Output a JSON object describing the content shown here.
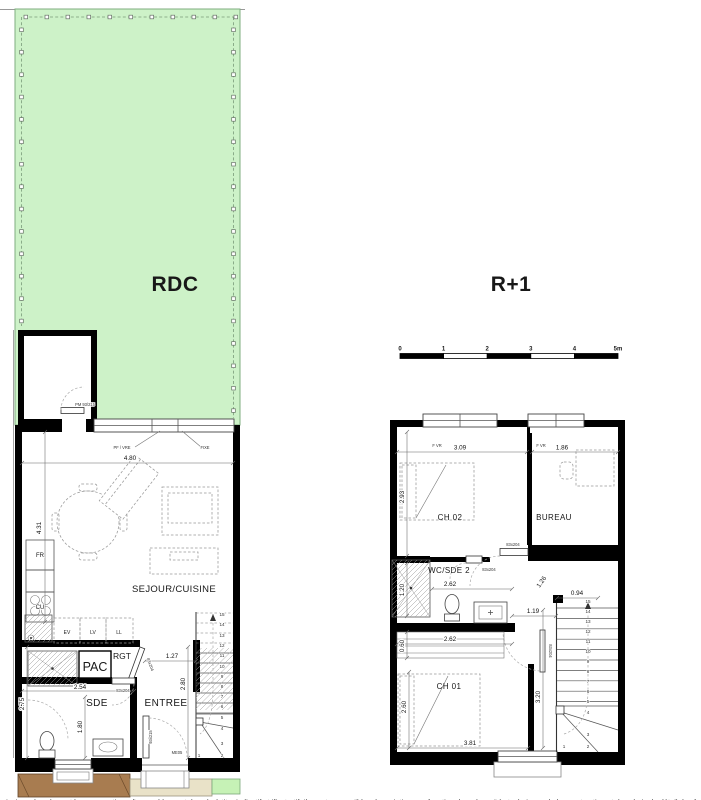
{
  "titles": {
    "rdc": "RDC",
    "r1": "R+1"
  },
  "scalebar": {
    "ticks": [
      "0",
      "1",
      "2",
      "3",
      "4",
      "5m"
    ]
  },
  "colors": {
    "garden": "#cdf2c8",
    "terrace": "#a87c50",
    "paving": "#e9e2c8",
    "grass": "#c6f2b6"
  },
  "rdc": {
    "annex_door_label": "PM 93/215",
    "window_left": "PF / VRE",
    "window_right": "FIXE",
    "dim_width": "4.80",
    "dim_height": "4.31",
    "appliance_fr": "FR",
    "appliance_cu": "CU",
    "appliance_ev": "EV",
    "appliance_lv": "LV",
    "appliance_ll": "LL",
    "room_main": "SEJOUR/CUISINE",
    "room_pac": "PAC",
    "room_rgt": "RGT",
    "room_sde": "SDE",
    "room_entree": "ENTREE",
    "dim_rgt": "1.27",
    "door_rgt": "83x204",
    "dim_sde_w": "2.54",
    "door_sde": "83x204",
    "dim_sde_h": "2.75",
    "dim_sde_inner": "1.80",
    "dim_entree_h": "2.80",
    "entry_door_size": "93x215",
    "entry_door_code": "ME05",
    "stair_numbers": [
      "15",
      "14",
      "13",
      "12",
      "11",
      "10",
      "9",
      "8",
      "7",
      "6",
      "5",
      "4",
      "3",
      "2",
      "1"
    ]
  },
  "r1": {
    "window_left_label": "F VR",
    "window_left_dim": "3.09",
    "window_right_label": "F VR",
    "window_right_dim": "1.86",
    "room_ch02": "CH 02",
    "room_bureau": "BUREAU",
    "room_wc": "WC/SDE 2",
    "room_ch01": "CH 01",
    "dim_ch02_h": "2.93",
    "dim_wc_h": "1.20",
    "dim_wc_w": "2.62",
    "dim_closet_w": "2.62",
    "dim_closet_h": "0.60",
    "dim_landing": "1.19",
    "dim_stair_top": "0.94",
    "dim_door_diag": "1.26",
    "door_landing": "83x204",
    "door_wc": "83x204",
    "door_ch01": "83x204",
    "dim_ch01_h": "2.60",
    "dim_ch01_w": "3.81",
    "dim_hall_h": "3.20",
    "stair_numbers": [
      "15",
      "14",
      "13",
      "12",
      "11",
      "10",
      "9",
      "8",
      "7",
      "6",
      "5",
      "4",
      "3",
      "2",
      "1"
    ]
  },
  "footer": {
    "disclaimer": "ainsi que les plans et les perspectives d'ensemble, sont donnés à titre indicatif et illustratif. Ils sont susceptibles de variations en fonction des nécessités techniques de la construction et des choix de détail des façades et des menuiseries."
  }
}
